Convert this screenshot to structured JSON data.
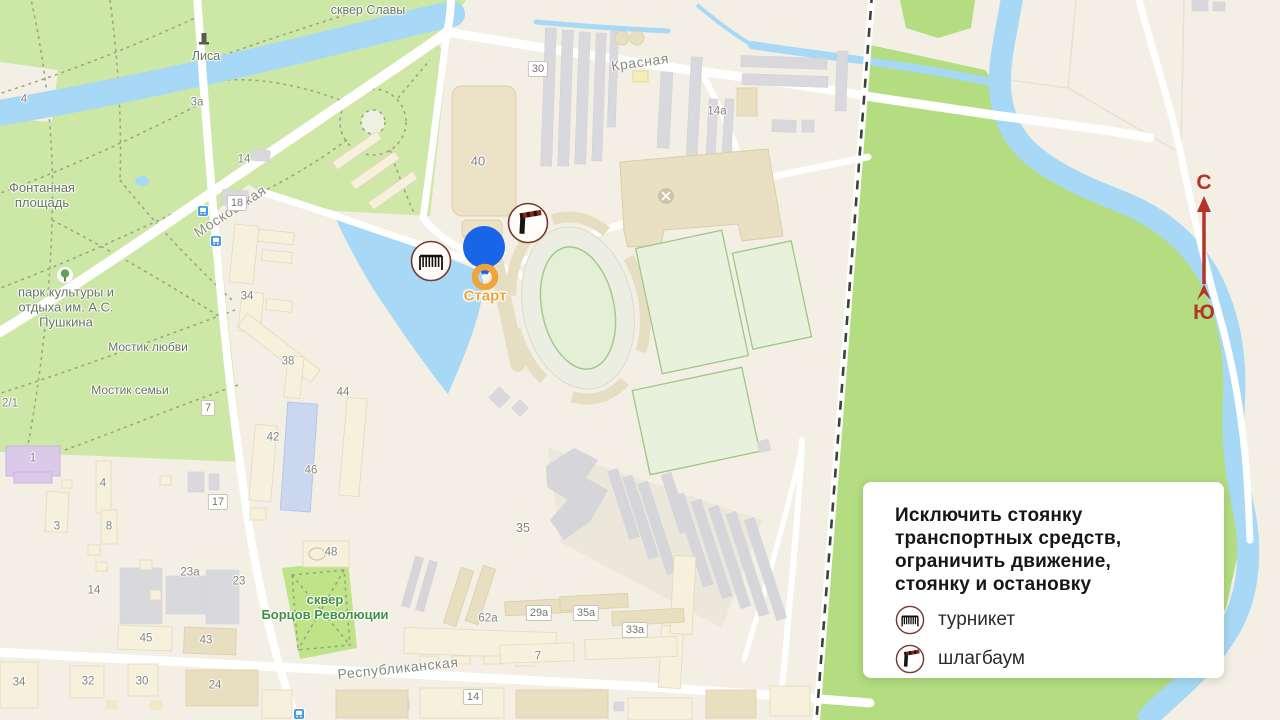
{
  "map": {
    "start": {
      "label": "Старт"
    },
    "compass": {
      "north": "С",
      "south": "Ю"
    },
    "labels": [
      {
        "text": "Московская",
        "x": 230,
        "y": 211,
        "rot": -33,
        "cls": "street"
      },
      {
        "text": "Красная",
        "x": 640,
        "y": 62,
        "rot": -8,
        "cls": "street"
      },
      {
        "text": "Республиканская",
        "x": 398,
        "y": 668,
        "rot": -6,
        "cls": "street"
      },
      {
        "text": "сквер Славы",
        "x": 368,
        "y": 10,
        "cls": "poi-gray",
        "size": 12.5
      },
      {
        "text": "Лиса",
        "x": 206,
        "y": 56,
        "cls": "poi-gray",
        "size": 12.5
      },
      {
        "text": "Фонтанная\nплощадь",
        "x": 42,
        "y": 196,
        "cls": "poi-gray"
      },
      {
        "text": "парк культуры и\nотдыха им. А.С.\nПушкина",
        "x": 66,
        "y": 308,
        "cls": "poi-gray"
      },
      {
        "text": "Мостик любви",
        "x": 148,
        "y": 348,
        "cls": "poi-gray",
        "size": 12
      },
      {
        "text": "Мостик семьи",
        "x": 130,
        "y": 391,
        "cls": "poi-gray",
        "size": 12
      },
      {
        "text": "сквер\nБорцов Революции",
        "x": 325,
        "y": 608,
        "cls": "poi-green"
      },
      {
        "text": "30",
        "x": 538,
        "y": 69,
        "cls": "plate"
      },
      {
        "text": "14а",
        "x": 717,
        "y": 112,
        "cls": "num"
      },
      {
        "text": "40",
        "x": 478,
        "y": 162,
        "cls": "num",
        "size": 13
      },
      {
        "text": "14",
        "x": 244,
        "y": 160,
        "cls": "num"
      },
      {
        "text": "18",
        "x": 237,
        "y": 203,
        "cls": "plate"
      },
      {
        "text": "3а",
        "x": 197,
        "y": 103,
        "cls": "num"
      },
      {
        "text": "4",
        "x": 24,
        "y": 100,
        "cls": "num"
      },
      {
        "text": "34",
        "x": 247,
        "y": 297,
        "cls": "num"
      },
      {
        "text": "38",
        "x": 288,
        "y": 362,
        "cls": "num"
      },
      {
        "text": "44",
        "x": 343,
        "y": 393,
        "cls": "num"
      },
      {
        "text": "42",
        "x": 273,
        "y": 438,
        "cls": "num"
      },
      {
        "text": "46",
        "x": 311,
        "y": 471,
        "cls": "num"
      },
      {
        "text": "7",
        "x": 208,
        "y": 408,
        "cls": "plate"
      },
      {
        "text": "2/1",
        "x": 10,
        "y": 404,
        "cls": "num"
      },
      {
        "text": "48",
        "x": 331,
        "y": 553,
        "cls": "num"
      },
      {
        "text": "35",
        "x": 523,
        "y": 528,
        "cls": "num",
        "size": 12.5
      },
      {
        "text": "1",
        "x": 33,
        "y": 459,
        "cls": "num"
      },
      {
        "text": "4",
        "x": 103,
        "y": 484,
        "cls": "num"
      },
      {
        "text": "3",
        "x": 57,
        "y": 527,
        "cls": "num"
      },
      {
        "text": "8",
        "x": 109,
        "y": 527,
        "cls": "num"
      },
      {
        "text": "17",
        "x": 218,
        "y": 502,
        "cls": "plate"
      },
      {
        "text": "14",
        "x": 94,
        "y": 591,
        "cls": "num"
      },
      {
        "text": "23а",
        "x": 190,
        "y": 573,
        "cls": "num"
      },
      {
        "text": "23",
        "x": 239,
        "y": 582,
        "cls": "num"
      },
      {
        "text": "45",
        "x": 146,
        "y": 639,
        "cls": "num"
      },
      {
        "text": "43",
        "x": 206,
        "y": 641,
        "cls": "num"
      },
      {
        "text": "34",
        "x": 19,
        "y": 683,
        "cls": "num"
      },
      {
        "text": "32",
        "x": 88,
        "y": 682,
        "cls": "num"
      },
      {
        "text": "30",
        "x": 142,
        "y": 682,
        "cls": "num"
      },
      {
        "text": "24",
        "x": 215,
        "y": 686,
        "cls": "num"
      },
      {
        "text": "62а",
        "x": 488,
        "y": 619,
        "cls": "num"
      },
      {
        "text": "29а",
        "x": 539,
        "y": 613,
        "cls": "plate"
      },
      {
        "text": "35а",
        "x": 586,
        "y": 613,
        "cls": "plate"
      },
      {
        "text": "33а",
        "x": 635,
        "y": 630,
        "cls": "plate"
      },
      {
        "text": "7",
        "x": 538,
        "y": 657,
        "cls": "num"
      },
      {
        "text": "14",
        "x": 473,
        "y": 697,
        "cls": "plate"
      }
    ]
  },
  "panel": {
    "title_lines": [
      "Исключить стоянку",
      "транспортных средств,",
      "ограничить движение,",
      "стоянку и остановку"
    ],
    "legend": [
      {
        "icon": "turnstile-icon",
        "label": "турникет"
      },
      {
        "icon": "barrier-icon",
        "label": "шлагбаум"
      }
    ]
  },
  "colors": {
    "water": "#A7D8F5",
    "park": "#CDE7A6",
    "meadow": "#B3DD80",
    "pin_blue": "#1865E8",
    "start_orange": "#F2A43C",
    "icon_border": "#77392B",
    "compass_red": "#B5342A"
  }
}
